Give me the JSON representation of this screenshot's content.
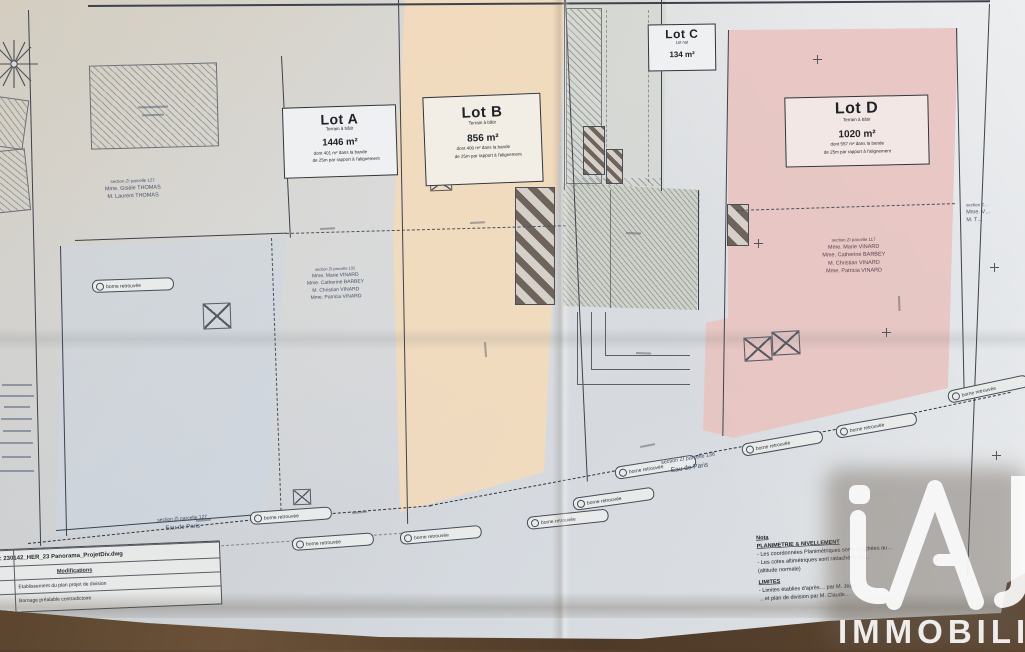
{
  "watermark": {
    "brand": "iad",
    "word": "IMMOBILIER"
  },
  "lots": {
    "a": {
      "title": "Lot A",
      "subtitle": "Terrain à bâtir",
      "area": "1446 m²",
      "note1": "dont 401 m² dans la bande",
      "note2": "de 25m par rapport à l'alignement"
    },
    "b": {
      "title": "Lot B",
      "subtitle": "Terrain à bâtir",
      "area": "856 m²",
      "note1": "dont 400 m² dans la bande",
      "note2": "de 25m par rapport à l'alignement"
    },
    "c": {
      "title": "Lot C",
      "subtitle": "Lot nat",
      "area": "134 m²"
    },
    "d": {
      "title": "Lot D",
      "subtitle": "Terrain à bâtir",
      "area": "1020 m²",
      "note1": "dont 557 m² dans la bande",
      "note2": "de 25m par rapport à l'alignement"
    }
  },
  "owners": {
    "parcel127": {
      "line1": "section ZI parcelle 127",
      "line2": "Mme. Gisèle THOMAS",
      "line3": "M. Laurent THOMAS"
    },
    "parcel132": {
      "line1": "section ZI parcelle 132",
      "line2": "Mme. Marie VINARD",
      "line3": "Mme. Catherine BARBEY",
      "line4": "M. Christian VINARD",
      "line5": "Mme. Patricia VINARD"
    },
    "parcel117": {
      "line1": "section ZI parcelle 117",
      "line2": "Mme. Marie VINARD",
      "line3": "Mme. Catherine BARBEY",
      "line4": "M. Christian VINARD",
      "line5": "Mme. Patricia VINARD"
    },
    "edge": {
      "line1": "section Z…",
      "line2": "Mme. V…",
      "line3": "M. T…"
    }
  },
  "roads": {
    "left": {
      "parcel": "section ZI parcelle 127",
      "name": "Eau de Paris"
    },
    "right": {
      "parcel": "section ZI parcelle 136",
      "name": "Eau de Paris"
    }
  },
  "callouts": {
    "borne": "borne retrouvée"
  },
  "title_block": {
    "file": "Fichier : 230142_HER_23 Panorama_ProjetDiv.dwg",
    "modifications": "Modifications",
    "row1": "Etablissement du plan projet de division",
    "row2": "Bornage préalable contradictoire"
  },
  "nota": {
    "title": "Nota",
    "h1": "PLANIMETRIE & NIVELLEMENT",
    "b1": "-  Les coordonnées Planimétriques sont rattachées au…",
    "b2": "-  Les cotes altimétriques sont rattachées au…",
    "b3": "   (altitude normale)",
    "h2": "LIMITES",
    "b4": "-  Limites établies d'après… par M. Jean…",
    "b5": "   …et plan de division par M. Claude…"
  },
  "colors": {
    "lot_b_fill": "#f4dcc0",
    "lot_d_fill": "#e9c5c2",
    "paper": "#d9dcdf",
    "wood": "#4a392a",
    "ink": "#3a4048"
  }
}
